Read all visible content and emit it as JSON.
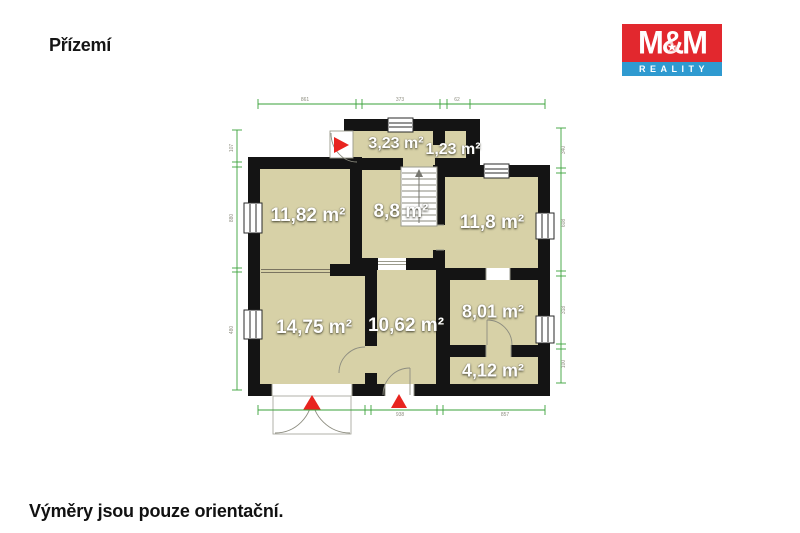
{
  "header": {
    "title": "Přízemí"
  },
  "footer": {
    "note": "Výměry jsou pouze orientační."
  },
  "logo": {
    "top": "M&M",
    "bottom": "REALITY",
    "star": "★"
  },
  "plan": {
    "rooms": [
      {
        "label": "3,23 m²"
      },
      {
        "label": "1,23 m²"
      },
      {
        "label": "11,82 m²"
      },
      {
        "label": "8,8 m²"
      },
      {
        "label": "11,8 m²"
      },
      {
        "label": "14,75 m²"
      },
      {
        "label": "10,62 m²"
      },
      {
        "label": "8,01 m²"
      },
      {
        "label": "4,12 m²"
      }
    ],
    "dims": {
      "top": [
        "861",
        "373",
        "62"
      ],
      "left": [
        "107",
        "880",
        "480"
      ],
      "right": [
        "340",
        "608",
        "318",
        "100"
      ],
      "bottom": [
        "938",
        "857"
      ]
    },
    "colors": {
      "floor": "#d7d1a7",
      "wall": "#141414",
      "dimension_line": "#3aa23a",
      "entrance_marker": "#e8241f",
      "logo_red": "#e2282e",
      "logo_blue": "#2f9ad0"
    }
  }
}
